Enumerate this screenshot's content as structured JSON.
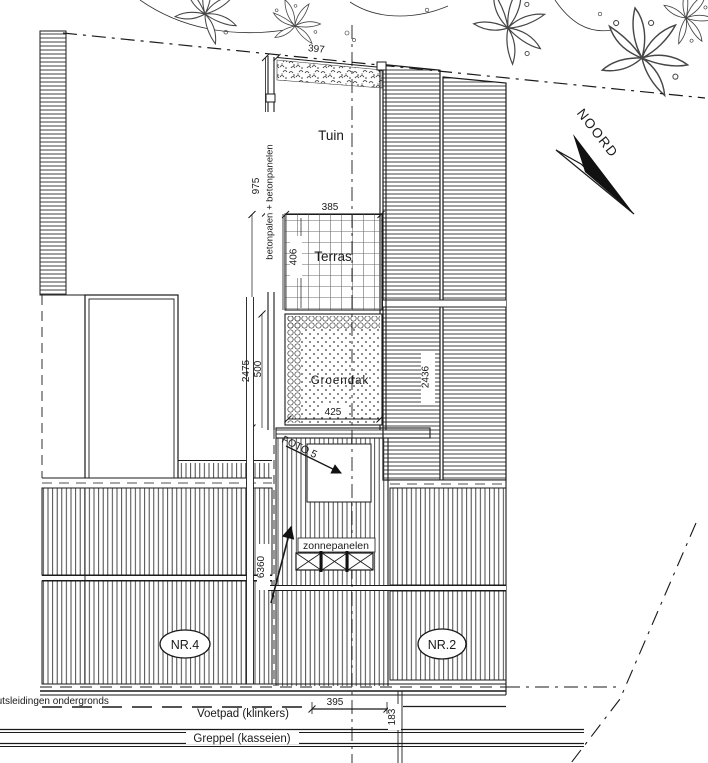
{
  "drawing": {
    "areas": {
      "tuin": "Tuin",
      "terras": "Terras",
      "groendak": "Groendak",
      "zonnepanelen": "zonnepanelen"
    },
    "houses": {
      "nr4": "NR.4",
      "nr2": "NR.2"
    },
    "annotations": {
      "fence": "betonpalen + betonpanelen",
      "foto5": "FOTO 5",
      "north": "NOORD",
      "utilities": "nutsleidingen ondergronds",
      "footpath": "Voetpad (klinkers)",
      "ditch": "Greppel (kasseien)"
    },
    "dimensions": {
      "plot_width_top": "397",
      "tuin_depth": "975",
      "terras_width": "385",
      "terras_depth": "406",
      "left_depth_total": "2475",
      "groendak_depth": "500",
      "groendak_width": "425",
      "right_depth": "2436",
      "house_depth": "6360",
      "footpath_width": "395",
      "footpath_offset": "183"
    },
    "colors": {
      "ink": "#1a1a1a",
      "paper": "#ffffff"
    }
  }
}
